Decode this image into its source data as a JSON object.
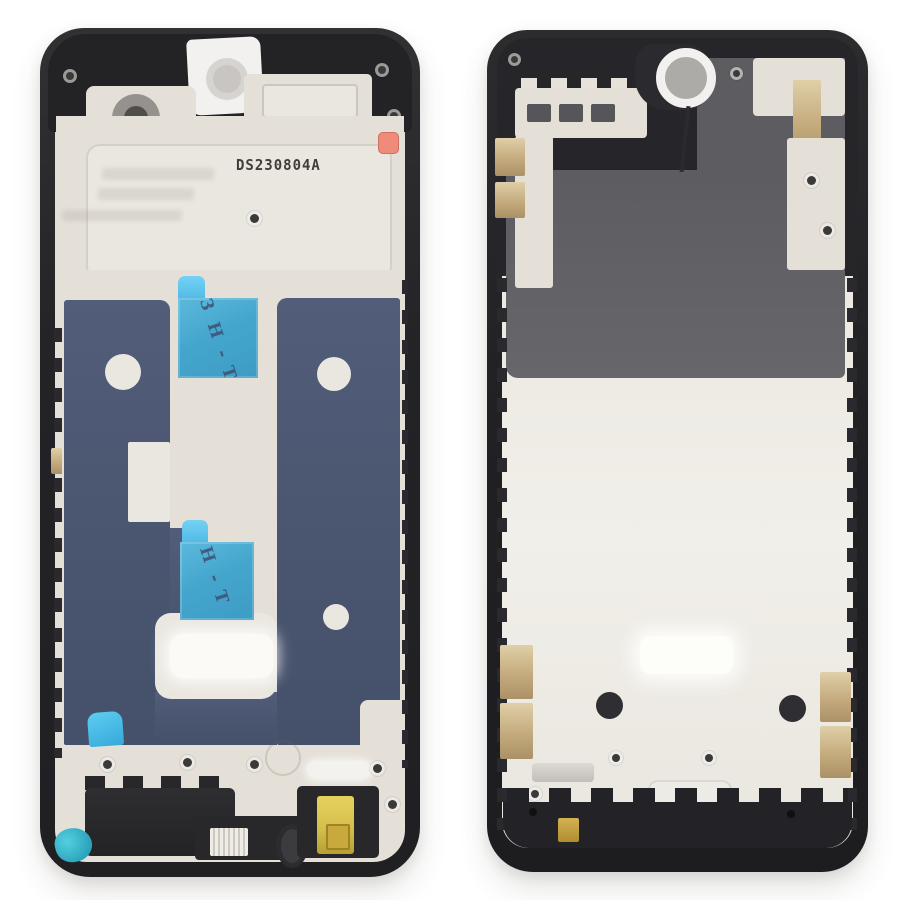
{
  "background": "#ffffff",
  "left_frame": {
    "serial": "DS230804A",
    "tape_upper_text": "3H-T",
    "tape_lower_text": "H-T"
  },
  "colors": {
    "bezel_black": "#232327",
    "housing_cream": "#e4e0d8",
    "adhesive_navy": "#4a556f",
    "tape_cyan": "#45a6cd",
    "tape_tab_cyan": "#5fc8f0",
    "display_panel_gray": "#616166",
    "contact_gold": "#c4ab7d",
    "headphone_jack_yellow": "#d9c24b",
    "sticker_salmon": "#ee8b7b",
    "corner_tab_teal": "#2fb3c6"
  }
}
